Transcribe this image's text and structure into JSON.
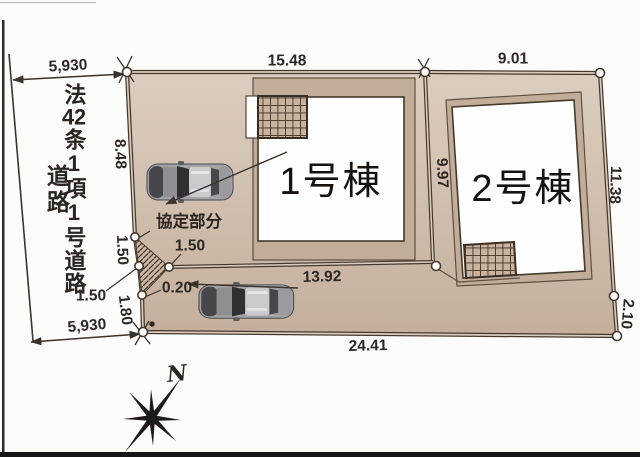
{
  "road": {
    "designation_parts": [
      "法",
      "42",
      "条",
      "1",
      "項",
      "1",
      "号",
      "道",
      "路"
    ],
    "road_label": "道路",
    "frontage_top": "5,930",
    "frontage_bottom": "5,930"
  },
  "dimensions": {
    "lot1_north": "15.48",
    "lot2_north": "9.01",
    "west_upper": "8.48",
    "divider": "9.97",
    "east_upper": "11.38",
    "east_lower": "2.10",
    "lot1_south": "13.92",
    "south_total": "24.41",
    "west_seg1": "1.50",
    "agreement_depth": "1.50",
    "west_seg2": "1.50",
    "west_seg3": "1.80",
    "edge_offset": "0.20"
  },
  "buildings": [
    {
      "label": "1号棟"
    },
    {
      "label": "2号棟"
    }
  ],
  "labels": {
    "agreement_area": "協定部分",
    "compass_north": "N"
  },
  "colors": {
    "land": "#cdb9a7",
    "land_dark": "#c2ad9a",
    "outline": "#46392c",
    "hatch": "#463223",
    "footprint": "#ffffff"
  }
}
